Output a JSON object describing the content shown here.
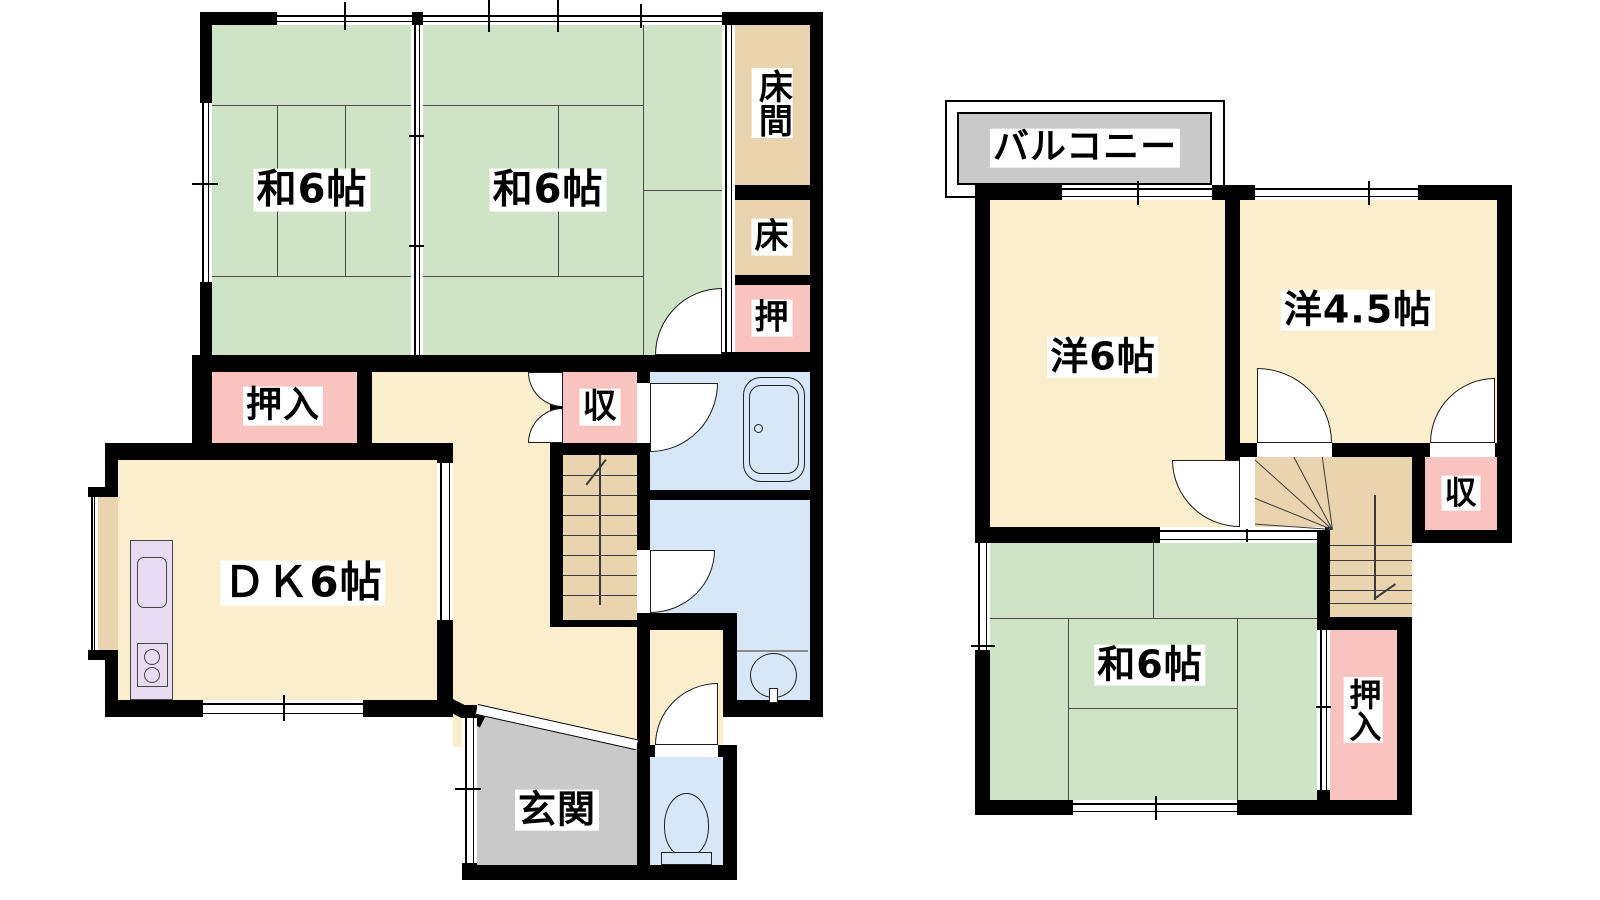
{
  "drawing": {
    "type": "japanese-house-floor-plan",
    "floors": 2
  },
  "colors": {
    "tatami_green": "#cfe3c6",
    "cream_room": "#fbeecd",
    "tan_wood": "#e9d4af",
    "closet_pink": "#f9c3c0",
    "wet_blue": "#d7e7f7",
    "entry_gray": "#c9c9c9",
    "kitchen_lavender": "#e7dcf2",
    "wall_black": "#000000"
  },
  "floor1": {
    "rooms": {
      "washitsu1": {
        "label": "和6帖"
      },
      "washitsu2": {
        "label": "和6帖"
      },
      "tokonoma": {
        "label": "床間"
      },
      "toko": {
        "label": "床"
      },
      "oshi": {
        "label": "押"
      },
      "oshiire": {
        "label": "押入"
      },
      "storage": {
        "label": "収"
      },
      "dk": {
        "label": "ＤＫ6帖"
      },
      "genkan": {
        "label": "玄関"
      }
    }
  },
  "floor2": {
    "rooms": {
      "balcony": {
        "label": "バルコニー"
      },
      "western6": {
        "label": "洋6帖"
      },
      "western45": {
        "label": "洋4.5帖"
      },
      "washitsu": {
        "label": "和6帖"
      },
      "oshiire": {
        "label": "押入"
      },
      "storage": {
        "label": "収"
      }
    }
  }
}
